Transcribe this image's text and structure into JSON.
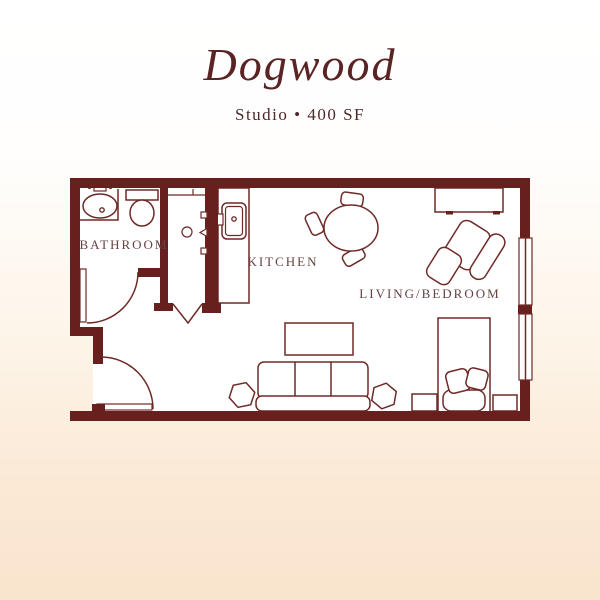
{
  "page": {
    "background_top_color": "#ffffff",
    "background_bottom_color": "#f9e4cd"
  },
  "header": {
    "title": "Dogwood",
    "subtitle": "Studio • 400 SF"
  },
  "plan": {
    "wall_color": "#67201e",
    "line_color": "#6e2a26",
    "label_color": "#664242",
    "rooms": [
      {
        "name": "bathroom",
        "label": "BATHROOM"
      },
      {
        "name": "kitchen",
        "label": "KITCHEN"
      },
      {
        "name": "living-bedroom",
        "label": "LIVING/BEDROOM"
      }
    ],
    "fixtures": [
      "bathroom-sink",
      "toilet",
      "closet-shelf",
      "closet-rod-knob",
      "kitchen-counter",
      "kitchen-sink",
      "dining-table",
      "dining-chair",
      "console-table",
      "armchair",
      "ottoman",
      "coffee-table",
      "sofa",
      "hexagon-side-table",
      "bed",
      "pillows",
      "nightstand",
      "entry-door",
      "bathroom-door",
      "closet-bifold-door",
      "window"
    ]
  }
}
